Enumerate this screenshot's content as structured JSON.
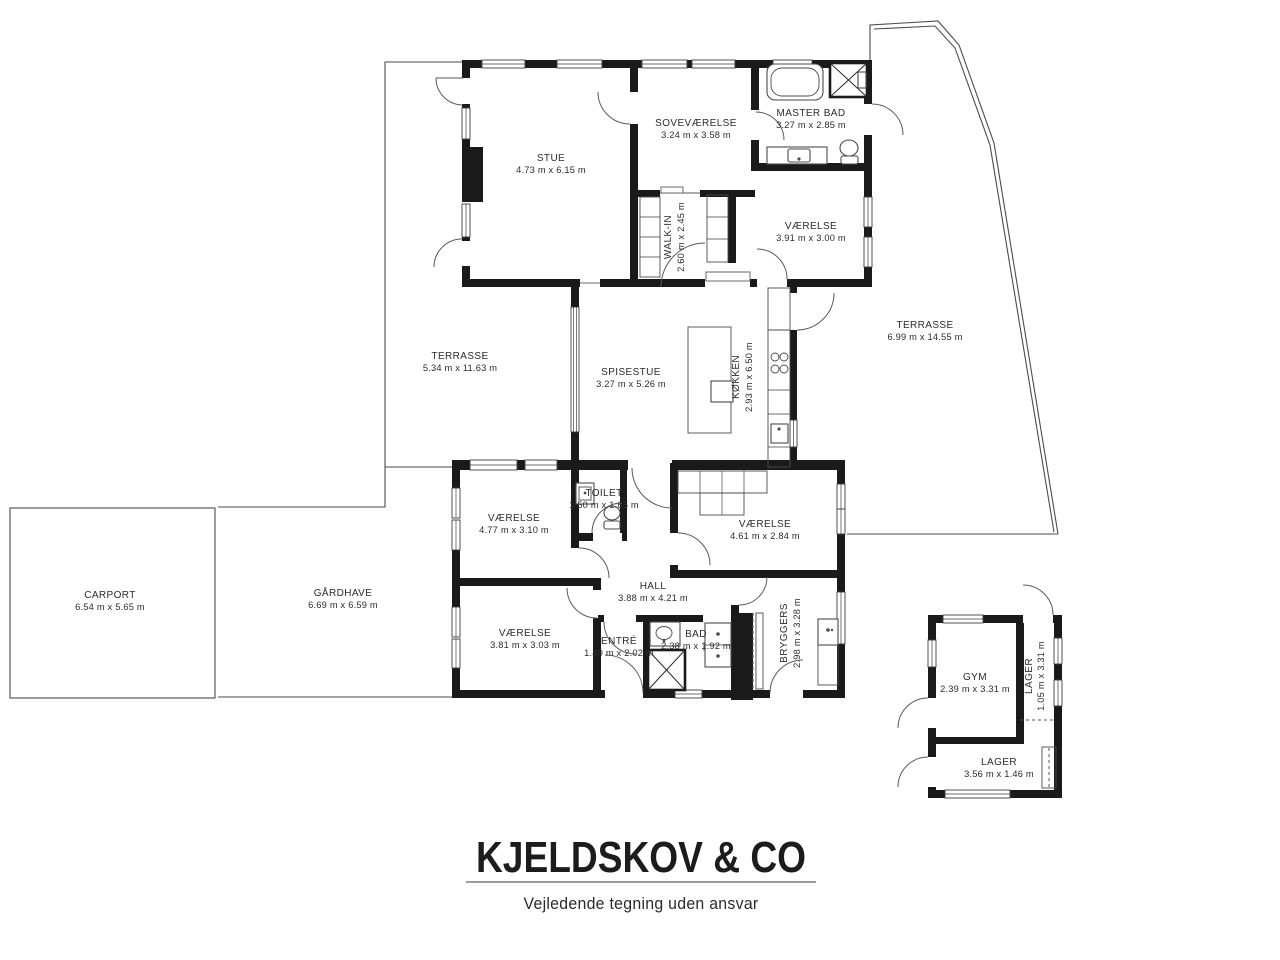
{
  "brand": {
    "title": "KJELDSKOV & CO",
    "disclaimer": "Vejledende tegning uden ansvar"
  },
  "rooms": {
    "stue": {
      "name": "STUE",
      "dims": "4.73 m x 6.15 m"
    },
    "sovevaerelse": {
      "name": "SOVEVÆRELSE",
      "dims": "3.24 m x 3.58 m"
    },
    "master_bad": {
      "name": "MASTER BAD",
      "dims": "3.27 m x 2.85 m"
    },
    "vaerelse_ne": {
      "name": "VÆRELSE",
      "dims": "3.91 m x 3.00 m"
    },
    "walk_in": {
      "name": "WALK-IN",
      "dims": "2.60 m x 2.45 m"
    },
    "terrasse_vest": {
      "name": "TERRASSE",
      "dims": "5.34 m x 11.63 m"
    },
    "spisestue": {
      "name": "SPISESTUE",
      "dims": "3.27 m x 5.26 m"
    },
    "koekken": {
      "name": "KØKKEN",
      "dims": "2.93 m x 6.50 m"
    },
    "terrasse_oest": {
      "name": "TERRASSE",
      "dims": "6.99 m x 14.55 m"
    },
    "vaerelse_vest": {
      "name": "VÆRELSE",
      "dims": "4.77 m x 3.10 m"
    },
    "toilet": {
      "name": "TOILET",
      "dims": "1.50 m x 1.65 m"
    },
    "vaerelse_oest": {
      "name": "VÆRELSE",
      "dims": "4.61 m x 2.84 m"
    },
    "hall": {
      "name": "HALL",
      "dims": "3.88 m x 4.21 m"
    },
    "vaerelse_syd": {
      "name": "VÆRELSE",
      "dims": "3.81 m x 3.03 m"
    },
    "entre": {
      "name": "ENTRÉ",
      "dims": "1.40 m x 2.02 m"
    },
    "bad": {
      "name": "BAD",
      "dims": "2.38 m x 1.92 m"
    },
    "bryggers": {
      "name": "BRYGGERS",
      "dims": "2.98 m x 3.28 m"
    },
    "carport": {
      "name": "CARPORT",
      "dims": "6.54 m x 5.65 m"
    },
    "gaardhave": {
      "name": "GÅRDHAVE",
      "dims": "6.69 m x 6.59 m"
    },
    "gym": {
      "name": "GYM",
      "dims": "2.39 m x 3.31 m"
    },
    "lager_hoej": {
      "name": "LAGER",
      "dims": "1.05 m x 3.31 m"
    },
    "lager_bred": {
      "name": "LAGER",
      "dims": "3.56 m x 1.46 m"
    }
  },
  "colors": {
    "wall": "#1a1a1a",
    "line": "#4b4b4b",
    "text": "#2c2c2c",
    "divider": "#9c9c9c",
    "background": "#ffffff"
  }
}
